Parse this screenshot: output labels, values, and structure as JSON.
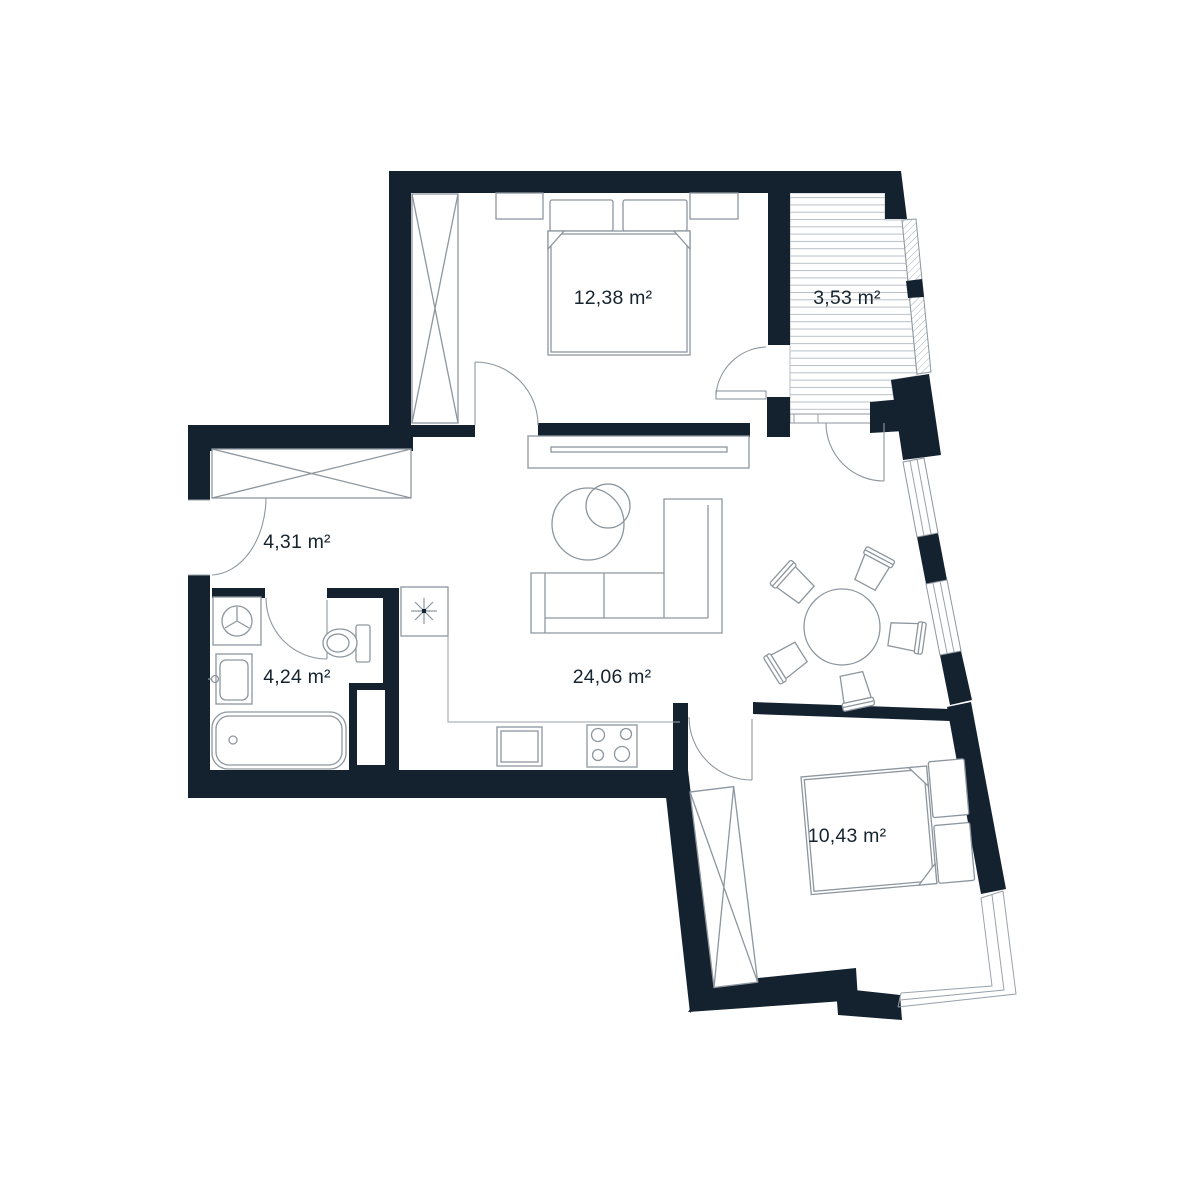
{
  "document": {
    "type": "apartment-floor-plan",
    "background": "#ffffff"
  },
  "colors": {
    "wall": "#14222f",
    "furniture_line": "#8d969e",
    "light_line": "#b9c0c6",
    "text": "#16242f"
  },
  "rooms": {
    "bedroom_1": {
      "area_label": "12,38 m²"
    },
    "balcony": {
      "area_label": "3,53 m²"
    },
    "hallway": {
      "area_label": "4,31 m²"
    },
    "bathroom": {
      "area_label": "4,24 m²"
    },
    "living_kitchen": {
      "area_label": "24,06 m²"
    },
    "bedroom_2": {
      "area_label": "10,43 m²"
    }
  }
}
